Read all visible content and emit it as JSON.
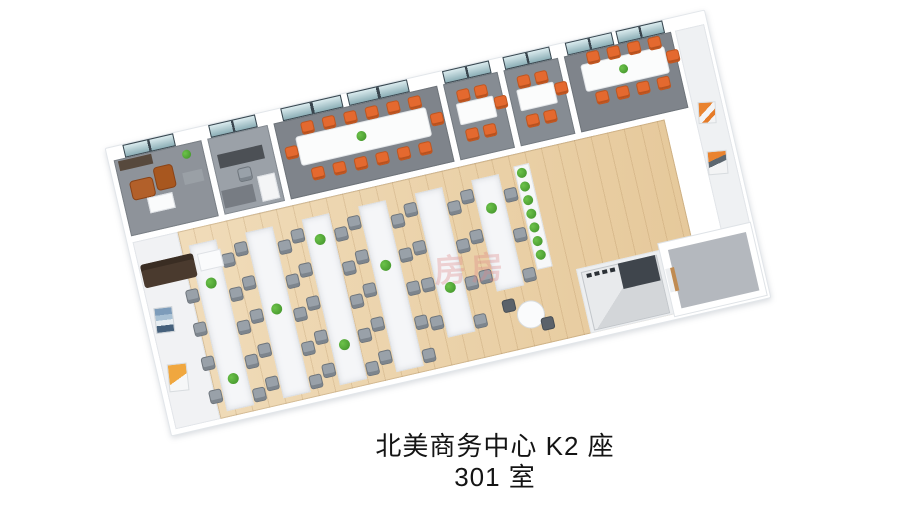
{
  "caption": {
    "line1": "北美商务中心 K2 座",
    "line2": "301 室"
  },
  "watermark": {
    "text": "房房"
  },
  "colors": {
    "wood_floor": "#ecd2a6",
    "wood_grain": "#d9b985",
    "carpet_dark": "#7f848b",
    "carpet_mid": "#8e939a",
    "carpet_light": "#9ba1a8",
    "corridor_carpet": "#7a7f87",
    "wall_white": "#ffffff",
    "accent_orange": "#e4692f",
    "plant_green": "#3e8f28",
    "window_teal": "#aed2d9",
    "desk_white": "#f5f6f8",
    "office_chair_gray": "#99a1a9",
    "sofa_brown": "#4a3a2e",
    "leather_brown": "#b2602a",
    "counter_gray": "#d3d6d9",
    "watermark_pink": "#dd8585"
  },
  "floorplan": {
    "top_rooms": [
      {
        "name": "lounge-room",
        "windows": 1,
        "orange_chairs": 0
      },
      {
        "name": "manager-office",
        "windows": 1,
        "orange_chairs": 0
      },
      {
        "name": "conference-room-large",
        "windows": 2,
        "orange_chairs": 14
      },
      {
        "name": "meeting-room-1",
        "windows": 1,
        "orange_chairs": 5
      },
      {
        "name": "meeting-room-2",
        "windows": 1,
        "orange_chairs": 5
      },
      {
        "name": "conference-room-2",
        "windows": 2,
        "orange_chairs": 9
      }
    ],
    "open_office": {
      "desk_rows": 6,
      "chairs_per_row": [
        10,
        10,
        10,
        10,
        8,
        6
      ],
      "bench_plant_rows": [
        [
          150,
          248
        ],
        [
          190
        ],
        [
          132,
          240
        ],
        [
          172
        ],
        [
          208
        ],
        [
          140
        ]
      ],
      "planter_plants": 7
    },
    "right_wing": {
      "artworks_on_wall": 2,
      "pantry_counter": 1,
      "storage_room": 1
    },
    "side_hall": {
      "artworks": 2,
      "sofa": 1
    }
  }
}
